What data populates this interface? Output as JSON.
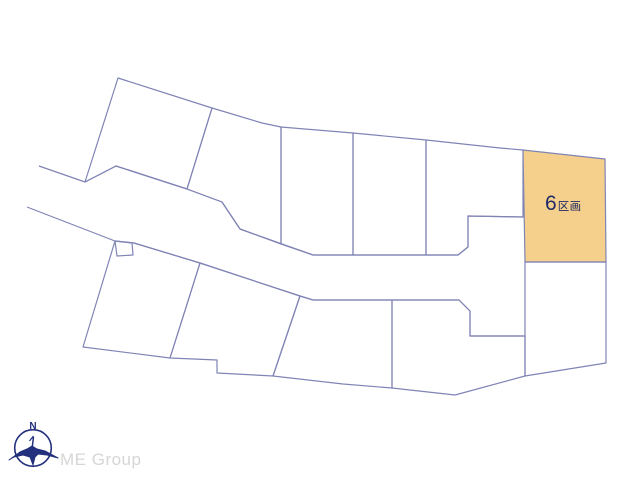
{
  "map": {
    "background": "#ffffff",
    "line_color": "#8084b5",
    "line_width": 1.2,
    "highlight_fill": "#f5d08c",
    "parcels": [
      {
        "id": "parcel-top-left",
        "points": [
          [
            118,
            78
          ],
          [
            212,
            108
          ],
          [
            187,
            189
          ],
          [
            116,
            166
          ],
          [
            85,
            182
          ]
        ]
      },
      {
        "id": "parcel-top-2",
        "points": [
          [
            212,
            108
          ],
          [
            262,
            123
          ],
          [
            281,
            127
          ],
          [
            281,
            244
          ],
          [
            240,
            229
          ],
          [
            222,
            202
          ],
          [
            187,
            189
          ]
        ]
      },
      {
        "id": "parcel-top-3",
        "points": [
          [
            281,
            127
          ],
          [
            353,
            133
          ],
          [
            353,
            255
          ],
          [
            313,
            255
          ],
          [
            281,
            244
          ]
        ]
      },
      {
        "id": "parcel-top-4",
        "points": [
          [
            353,
            133
          ],
          [
            426,
            140
          ],
          [
            426,
            255
          ],
          [
            353,
            255
          ]
        ]
      },
      {
        "id": "parcel-top-5",
        "points": [
          [
            426,
            140
          ],
          [
            500,
            148
          ],
          [
            523,
            150
          ],
          [
            523,
            217
          ],
          [
            468,
            216
          ],
          [
            468,
            247
          ],
          [
            458,
            255
          ],
          [
            426,
            255
          ]
        ]
      },
      {
        "id": "parcel-6-highlight",
        "points": [
          [
            523,
            150
          ],
          [
            605,
            159
          ],
          [
            606,
            262
          ],
          [
            525,
            262
          ]
        ],
        "highlighted": true
      },
      {
        "id": "parcel-below-6",
        "points": [
          [
            525,
            262
          ],
          [
            606,
            262
          ],
          [
            606,
            363
          ],
          [
            525,
            376
          ]
        ]
      },
      {
        "id": "parcel-lower-left",
        "points": [
          [
            115,
            241
          ],
          [
            134,
            243
          ],
          [
            200,
            263
          ],
          [
            170,
            358
          ],
          [
            83,
            347
          ]
        ]
      },
      {
        "id": "parcel-lower-2",
        "points": [
          [
            200,
            263
          ],
          [
            300,
            296
          ],
          [
            273,
            376
          ],
          [
            217,
            373
          ],
          [
            217,
            360
          ],
          [
            170,
            358
          ]
        ]
      },
      {
        "id": "parcel-lower-3",
        "points": [
          [
            300,
            296
          ],
          [
            313,
            300
          ],
          [
            392,
            300
          ],
          [
            392,
            388
          ],
          [
            343,
            384
          ],
          [
            273,
            376
          ]
        ]
      },
      {
        "id": "parcel-lower-4",
        "points": [
          [
            392,
            300
          ],
          [
            459,
            300
          ],
          [
            470,
            311
          ],
          [
            470,
            336
          ],
          [
            525,
            336
          ],
          [
            525,
            376
          ],
          [
            455,
            395
          ],
          [
            392,
            388
          ]
        ]
      }
    ],
    "road_edges": [
      {
        "id": "upper-road-edge",
        "points": [
          [
            39,
            166
          ],
          [
            85,
            182
          ],
          [
            116,
            166
          ],
          [
            187,
            189
          ],
          [
            222,
            202
          ],
          [
            240,
            229
          ],
          [
            313,
            255
          ],
          [
            458,
            255
          ],
          [
            468,
            247
          ],
          [
            468,
            216
          ],
          [
            523,
            217
          ]
        ]
      },
      {
        "id": "lower-road-edge",
        "points": [
          [
            27,
            207
          ],
          [
            115,
            241
          ],
          [
            134,
            243
          ],
          [
            200,
            263
          ],
          [
            300,
            296
          ],
          [
            313,
            300
          ],
          [
            459,
            300
          ],
          [
            470,
            311
          ],
          [
            470,
            336
          ],
          [
            525,
            336
          ]
        ]
      }
    ],
    "notch": {
      "id": "road-notch-square",
      "points": [
        [
          115,
          241
        ],
        [
          117,
          256
        ],
        [
          133,
          255
        ],
        [
          132,
          243
        ]
      ]
    }
  },
  "highlight_label": {
    "number": "6",
    "suffix": "区画",
    "color": "#1f2a66"
  },
  "compass": {
    "north_label": "N",
    "color": "#23307d",
    "circle": {
      "cx": 33,
      "cy": 448,
      "r": 18.3
    },
    "needle": [
      [
        33.5,
        437
      ],
      [
        31.5,
        453
      ]
    ],
    "barb": [
      [
        33.5,
        436
      ],
      [
        29.5,
        441
      ]
    ],
    "bird": [
      [
        9,
        460
      ],
      [
        20,
        452
      ],
      [
        27,
        449
      ],
      [
        32,
        446
      ],
      [
        37,
        449
      ],
      [
        45,
        451
      ],
      [
        58,
        458
      ],
      [
        47,
        455
      ],
      [
        38,
        454
      ],
      [
        35,
        457
      ],
      [
        33,
        465
      ],
      [
        30,
        457
      ],
      [
        23,
        455
      ],
      [
        14,
        457
      ]
    ]
  },
  "watermark": {
    "text": "ME Group",
    "color": "#d6d6d6"
  }
}
